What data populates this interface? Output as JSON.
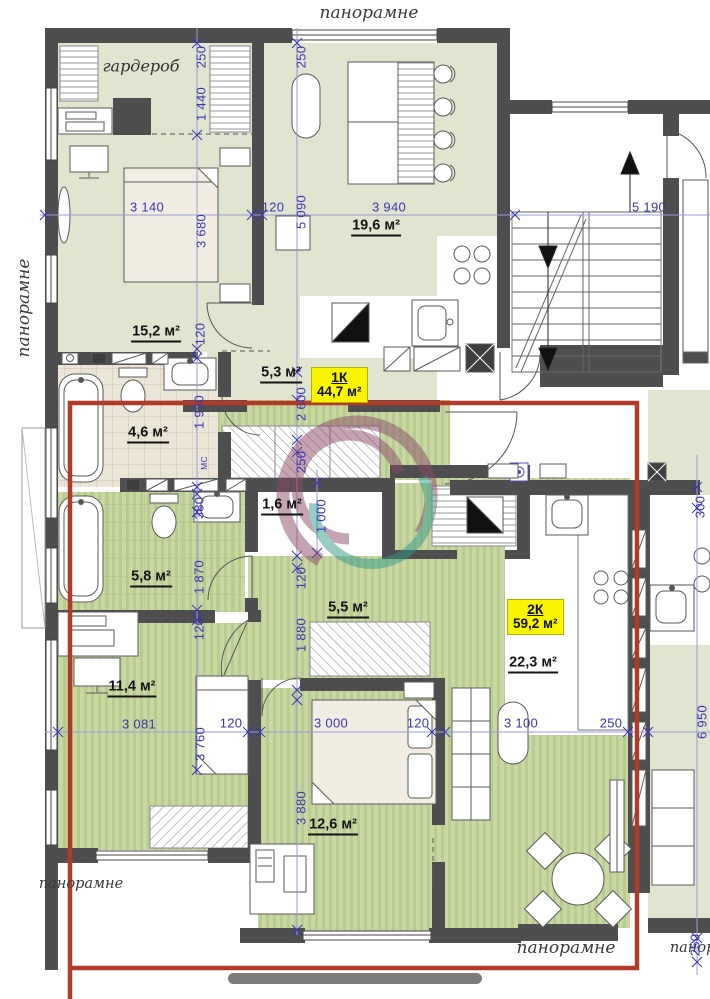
{
  "titles": {
    "top": "панорамне",
    "left": "панорамне",
    "bottom_left": "панорамне",
    "bottom_right": "панорамне",
    "bottom_right_clipped": "панорамне"
  },
  "tags": {
    "apt1": {
      "name": "1К",
      "area": "44,7 м²"
    },
    "apt2": {
      "name": "2К",
      "area": "59,2 м²"
    }
  },
  "rooms": {
    "wardrobe": "гардероб",
    "bedroom_15": "15,2 м²",
    "living_19": "19,6 м²",
    "hall_5_3": "5,3 м²",
    "bath_4_6": "4,6 м²",
    "bath_5_8": "5,8 м²",
    "closet_1_6": "1,6 м²",
    "hall_5_5": "5,5 м²",
    "bedroom_11": "11,4 м²",
    "living_22": "22,3 м²",
    "bedroom_12": "12,6 м²",
    "utility": "МС"
  },
  "dims": {
    "h_top": [
      "3 140",
      "120",
      "3 940",
      "5 190"
    ],
    "h_bottom": [
      "3 081",
      "120",
      "3 000",
      "120",
      "3 100",
      "250"
    ],
    "v": [
      "250",
      "1 440",
      "250",
      "3 680",
      "5 090",
      "120",
      "1 930",
      "2 600",
      "250",
      "380",
      "1 000",
      "1 870",
      "120",
      "1 880",
      "120",
      "3 760",
      "3 880",
      "300",
      "6 950",
      "250"
    ]
  },
  "colors": {
    "highlight_rect": "#b43a28",
    "dimension_text": "#3a35b2",
    "tag_bg": "#f9f500",
    "wall": "#4e4e4e",
    "floor_green_striped": "#c9d7a2",
    "floor_pale": "#e1e4cf",
    "floor_tile_beige": "#eae5d6",
    "watermark_purple": "#8c4a67",
    "watermark_teal": "#2f9a86",
    "bottom_bar": "#7c7c7c"
  }
}
